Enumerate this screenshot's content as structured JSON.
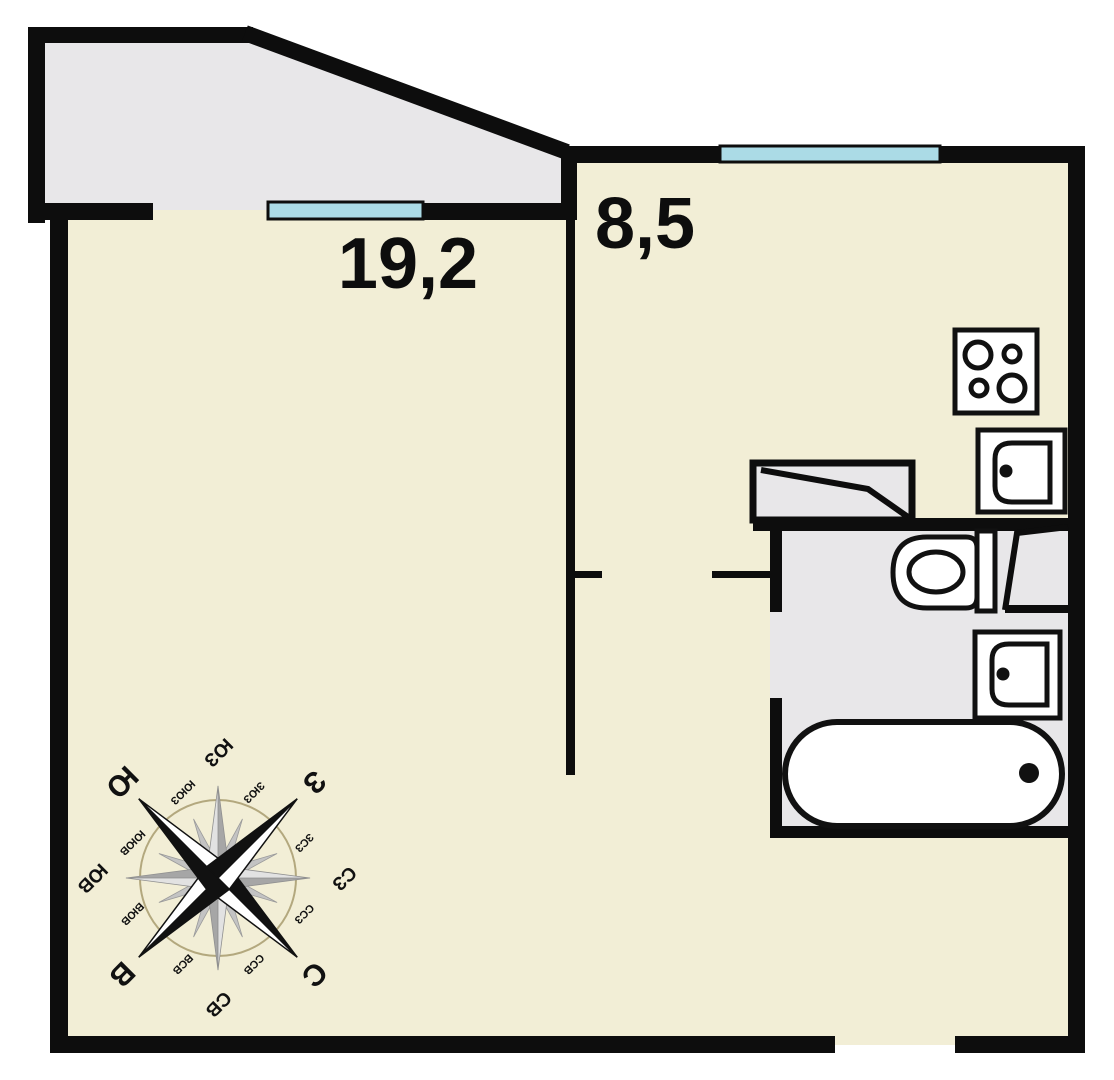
{
  "plan": {
    "type": "apartment-floor-plan",
    "rooms": {
      "living_room": {
        "area": "19,2"
      },
      "kitchen": {
        "area": "8,5"
      }
    },
    "colors": {
      "floor": "#f2eed6",
      "annex": "#e8e7e9",
      "wall": "#0d0d0d",
      "window": "#abdbe6",
      "fixture_fill": "#ffffff",
      "compass_dark": "#a6a6a6",
      "compass_light": "#e2e2e2",
      "compass_minor": "#c3c3c3",
      "compass_ring": "#b3a87e"
    },
    "fixtures": {
      "stove": "stove-4-burner-icon",
      "kitchen_sink": "sink-icon",
      "toilet": "toilet-icon",
      "bathroom_sink": "sink-icon",
      "bathtub": "bathtub-icon"
    },
    "compass": {
      "rotation_deg": 135,
      "labels": [
        {
          "dir": "N",
          "text": "С"
        },
        {
          "dir": "NNE",
          "text": "ССВ"
        },
        {
          "dir": "NE",
          "text": "СВ"
        },
        {
          "dir": "ENE",
          "text": "ВСВ"
        },
        {
          "dir": "E",
          "text": "В"
        },
        {
          "dir": "ESE",
          "text": "ВЮВ"
        },
        {
          "dir": "SE",
          "text": "ЮВ"
        },
        {
          "dir": "SSE",
          "text": "ЮЮВ"
        },
        {
          "dir": "S",
          "text": "Ю"
        },
        {
          "dir": "SSW",
          "text": "ЮЮЗ"
        },
        {
          "dir": "SW",
          "text": "ЮЗ"
        },
        {
          "dir": "WSW",
          "text": "ЗЮЗ"
        },
        {
          "dir": "W",
          "text": "З"
        },
        {
          "dir": "WNW",
          "text": "ЗСЗ"
        },
        {
          "dir": "NW",
          "text": "СЗ"
        },
        {
          "dir": "NNW",
          "text": "ССЗ"
        }
      ]
    }
  }
}
